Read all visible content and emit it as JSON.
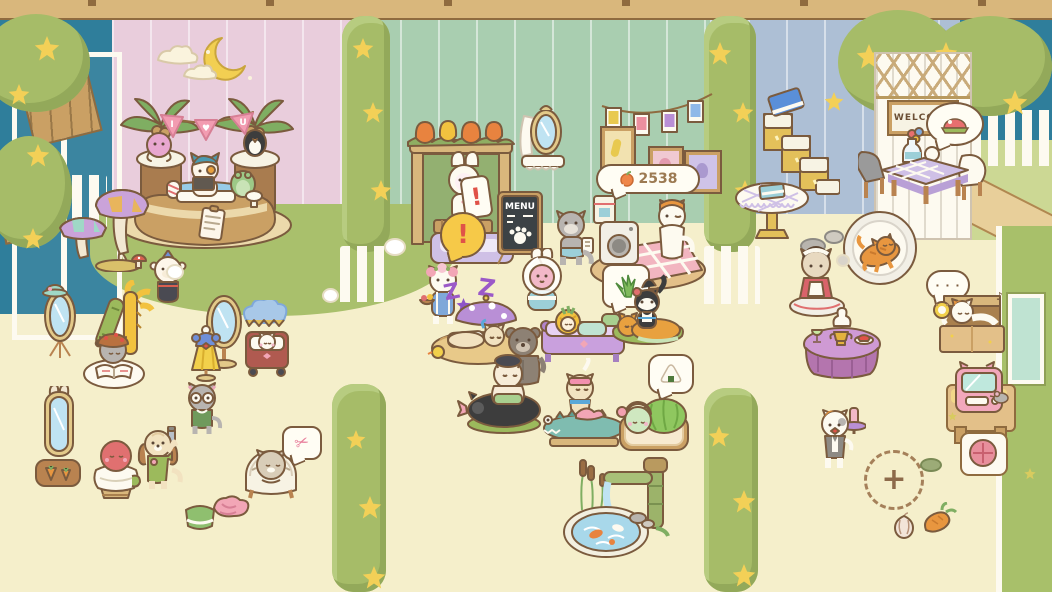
{
  "scene": {
    "name": "cat garden spa room"
  },
  "signs": {
    "welcome": "WELCOME",
    "menu": "MENU"
  },
  "banner_flags": [
    "I",
    "♥",
    "U"
  ],
  "counter": {
    "icon": "peach-icon",
    "value": "2538"
  },
  "icons": {
    "exclamation": "!",
    "ellipsis": "· · ·",
    "music_note": "♪",
    "scissors": "✂",
    "plus": "+"
  },
  "sleep": {
    "z1": "Z",
    "z2": "Z",
    "z3": "z"
  },
  "colors": {
    "beam": "#d9b77c",
    "night_sky": "#2f7e9b",
    "wall_pink": "#e9cddc",
    "wall_green": "#a9ceb0",
    "wall_blue": "#adbfd5",
    "wall_green_right": "#a8c06a",
    "grass": "#a9c06c",
    "floor": "#f5efcb",
    "hedge": "#a6bc68",
    "star": "#f3d057",
    "outline": "#7b5b3e",
    "bubble_fill": "#fffdf4",
    "sleep_purple": "#9b59c8",
    "flag_pink": "#f29cb1"
  }
}
